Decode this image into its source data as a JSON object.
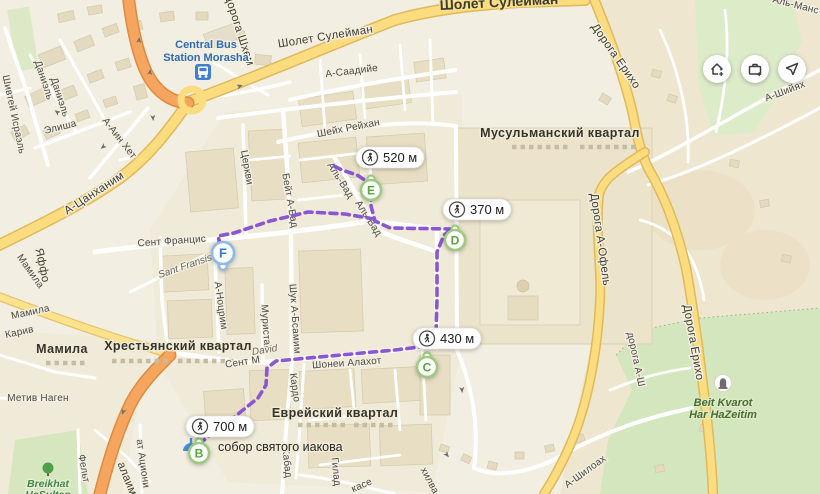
{
  "map_controls": [
    {
      "icon": "add-home-icon"
    },
    {
      "icon": "add-work-icon"
    },
    {
      "icon": "locate-arrow-icon"
    }
  ],
  "route": {
    "color": "#8a56d2",
    "badges": [
      {
        "distance": "520 м",
        "icon": "pedestrian-icon"
      },
      {
        "distance": "370 м",
        "icon": "pedestrian-icon"
      },
      {
        "distance": "430 м",
        "icon": "pedestrian-icon"
      },
      {
        "distance": "700 м",
        "icon": "pedestrian-icon"
      }
    ],
    "waypoints": [
      {
        "letter": "B",
        "color": "#57a63d"
      },
      {
        "letter": "C",
        "color": "#57a63d"
      },
      {
        "letter": "D",
        "color": "#57a63d"
      },
      {
        "letter": "E",
        "color": "#57a63d"
      },
      {
        "letter": "F",
        "color": "#2f7fd6"
      }
    ]
  },
  "districts": [
    {
      "name": "Мусульманский квартал"
    },
    {
      "name": "Хрестьянский квартал"
    },
    {
      "name": "Еврейский квартал"
    },
    {
      "name": "Мамила"
    }
  ],
  "streets": [
    {
      "name": "Шолет Сулейман"
    },
    {
      "name": "Шолет Сулейман"
    },
    {
      "name": "Дорога Шхем"
    },
    {
      "name": "Шивтей Исраэль"
    },
    {
      "name": "Даниэль"
    },
    {
      "name": "Даниэль"
    },
    {
      "name": "Элиша"
    },
    {
      "name": "А-Аин Хет"
    },
    {
      "name": "А-Цанханим"
    },
    {
      "name": "Яффо"
    },
    {
      "name": "Мамила"
    },
    {
      "name": "Мамила"
    },
    {
      "name": "Карив"
    },
    {
      "name": "Метив Наген"
    },
    {
      "name": "Фельт"
    },
    {
      "name": "алаим"
    },
    {
      "name": "ат Ациони"
    },
    {
      "name": "Сент Францис"
    },
    {
      "name": "Sant Fransis"
    },
    {
      "name": "Церкви"
    },
    {
      "name": "Бейт А-Бад"
    },
    {
      "name": "Аль-Вад"
    },
    {
      "name": "Аль-Вад"
    },
    {
      "name": "А-Саадийе"
    },
    {
      "name": "Шейх Рейхан"
    },
    {
      "name": "А-Ноцрим"
    },
    {
      "name": "Муристан"
    },
    {
      "name": "Шук А-Бсамим"
    },
    {
      "name": "David"
    },
    {
      "name": "Сент М"
    },
    {
      "name": "Шонеи Алахот"
    },
    {
      "name": "Кардо"
    },
    {
      "name": "Хабад"
    },
    {
      "name": "Гилад"
    },
    {
      "name": "касе"
    },
    {
      "name": "хилва"
    },
    {
      "name": "Дорога Ерихо"
    },
    {
      "name": "Дорога А-Офель"
    },
    {
      "name": "Дорога Ерихо"
    },
    {
      "name": "Аль-Манс"
    },
    {
      "name": "А-Шийях"
    },
    {
      "name": "дорога А-Ш"
    },
    {
      "name": "А-Шилоах"
    }
  ],
  "pois": [
    {
      "name": "Central Bus Station Morasha",
      "line1": "Central Bus",
      "line2": "Station Morasha",
      "icon": "bus-icon"
    },
    {
      "name": "собор святого иакова",
      "icon": "church-icon"
    },
    {
      "name": "Beit Kvarot Har HaZeitim",
      "line1": "Beit Kvarot",
      "line2": "Har HaZeitim",
      "icon": "tombstone-icon"
    },
    {
      "name": "Breikhat HaSultan",
      "line1": "Breikhat",
      "line2": "HaSultan",
      "icon": "tree-icon"
    }
  ]
}
